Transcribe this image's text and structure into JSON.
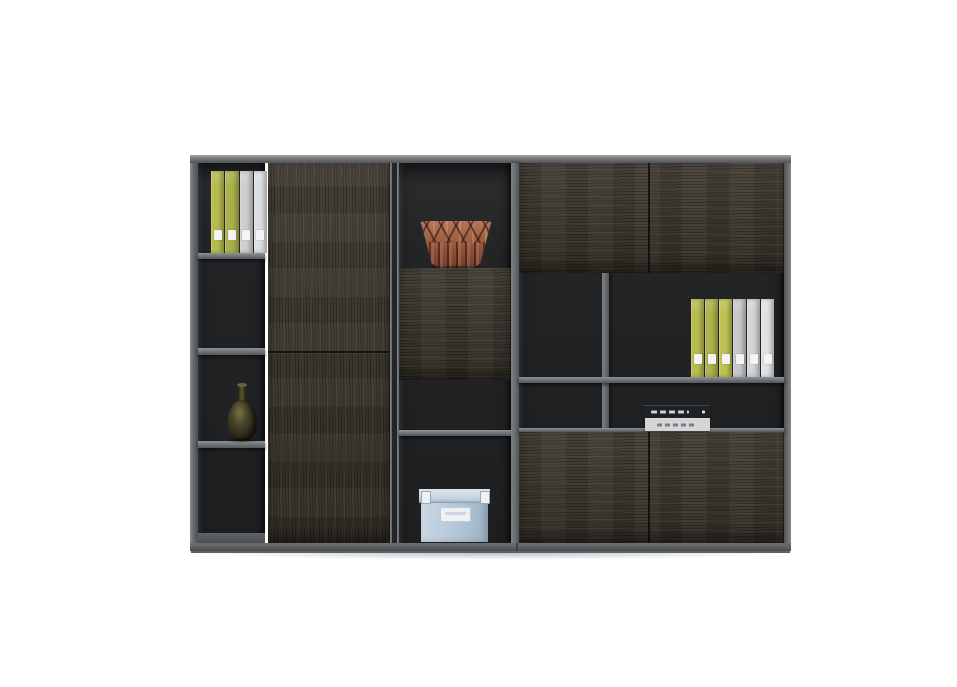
{
  "scene": {
    "type": "furniture-product-photo",
    "subject": "Dark smoked-oak office wall cabinet with gray frame, open display shelves and handleless doors",
    "background": "#ffffff"
  },
  "palette": {
    "background": "#ffffff",
    "frame": "#73777b",
    "frame_dark": "#54585b",
    "interior": "#222426",
    "wood": "#3e382f",
    "wood_light": "#564f3e",
    "plinth": "#5d6164",
    "accent_green": "#b4bb4d",
    "binder_white": "#d7d9db",
    "copper": "#9c5f43",
    "copper_light": "#b4775a",
    "box_blue": "#b6c8d8",
    "box_label": "#eef1f4"
  },
  "objects": {
    "binders_top_left": {
      "count": 4,
      "colors": [
        "#b6bd4f",
        "#aab14a",
        "#cdcfd1",
        "#dddfe1"
      ],
      "label_color": "#f2f4f6"
    },
    "binders_middle_right": {
      "count": 6,
      "colors": [
        "#b6bd4f",
        "#acb34b",
        "#bcc252",
        "#c6c8ca",
        "#d3d5d7",
        "#dfe1e3"
      ],
      "label_color": "#f2f4f6"
    },
    "copper_vase": {
      "style": "faceted origami bowl",
      "color": "#9c5f43"
    },
    "bottle_vase": {
      "style": "slim dark bronze bottle",
      "color": "#35331f"
    },
    "storage_box": {
      "style": "lidded box with metal corner clips and label plate",
      "color": "#b6c8d8"
    },
    "books": {
      "count": 2,
      "top_color": "#1f2224",
      "bottom_color": "#d3d5d7",
      "spine_text_legible": false
    }
  },
  "structure": {
    "left_unit": [
      "open column: binders / empty / bottle vase / empty",
      "tall door with mid seam"
    ],
    "center_column": [
      "open niche with copper bowl",
      "wood panel",
      "open niche",
      "open niche with storage box"
    ],
    "right_grid": [
      "two top doors",
      "open row with divider + 6 binders",
      "open row with 2 stacked books",
      "two bottom doors"
    ]
  }
}
